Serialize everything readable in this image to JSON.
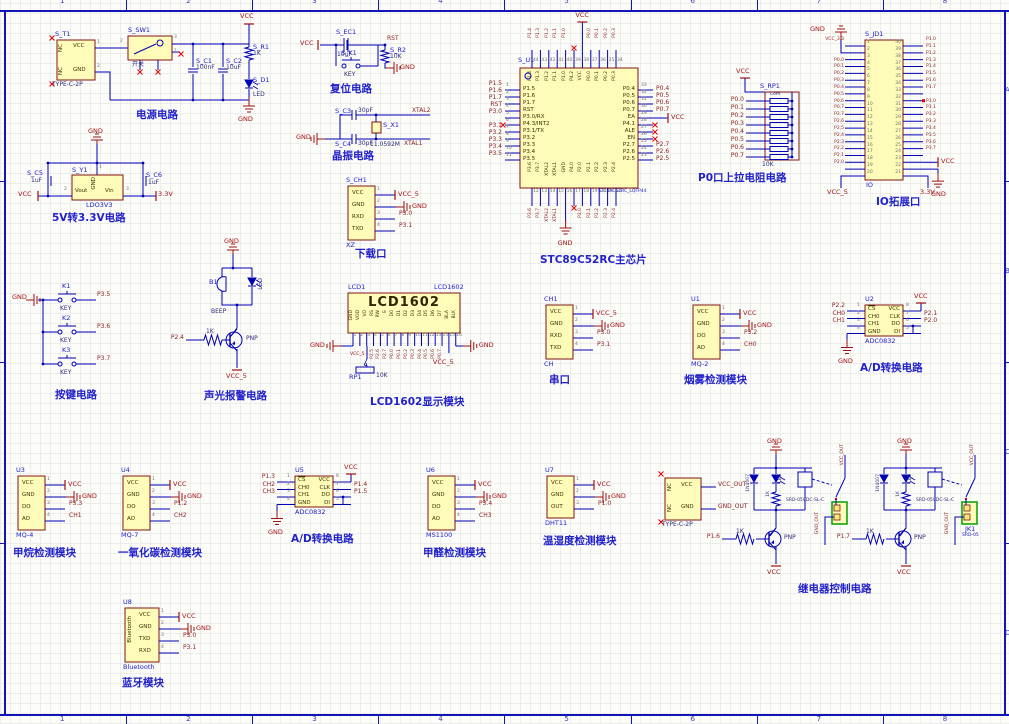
{
  "sheet": {
    "column_labels": [
      "1",
      "2",
      "3",
      "4",
      "5",
      "6",
      "7",
      "8"
    ],
    "row_labels": [
      "A",
      "B",
      "C",
      "D"
    ]
  },
  "colors": {
    "wire": "#0000b4",
    "part_fill": "#fffbb8",
    "part_border": "#801515",
    "net_label": "#8b1c1c",
    "power": "#a01010",
    "designator": "#1a1ad0",
    "caption": "#2222cc",
    "terminal_green": "#00a000"
  },
  "power_circuit": {
    "caption": "电源电路",
    "vcc": "VCC",
    "gnd": "GND",
    "t1": {
      "designator": "S_T1",
      "part": "TYPE-C-2P",
      "pin_vcc": "VCC",
      "pin_gnd": "GND",
      "nc": "NC",
      "pin1": "1",
      "pin2": "2"
    },
    "sw": {
      "designator": "S_SW1",
      "label": "开关",
      "pin2": "2",
      "pin3": "3",
      "pin1": "1"
    },
    "c1": {
      "designator": "S_C1",
      "value": "100nF"
    },
    "c2": {
      "designator": "S_C2",
      "value": "10uF"
    },
    "r1": {
      "designator": "S_R1",
      "value": "1K"
    },
    "d1": {
      "designator": "S_D1",
      "label": "LED"
    }
  },
  "ldo_circuit": {
    "caption": "5V转3.3V电路",
    "gnd": "GND",
    "vcc": "VCC",
    "v33": "3.3V",
    "y1": {
      "designator": "S_Y1",
      "part": "LDO3V3",
      "pin_vout": "Vout",
      "pin_gnd": "GND",
      "pin_vin": "Vin",
      "n1": "1",
      "n2": "2",
      "n3": "3"
    },
    "c5": {
      "designator": "S_C5",
      "value": "1uF"
    },
    "c6": {
      "designator": "S_C6",
      "value": "1uF"
    }
  },
  "reset_circuit": {
    "caption": "复位电路",
    "vcc": "VCC",
    "rst": "RST",
    "gnd": "GND",
    "ec1": {
      "designator": "S_EC1",
      "value": "10uF"
    },
    "k1": {
      "designator": "S_K1",
      "label": "KEY"
    },
    "r2": {
      "designator": "S_R2",
      "value": "10K"
    }
  },
  "crystal_circuit": {
    "caption": "晶振电路",
    "gnd": "GND",
    "xtal2": "XTAL2",
    "xtal1": "XTAL1",
    "c3": {
      "designator": "S_C3",
      "value": "30pF"
    },
    "c4": {
      "designator": "S_C4",
      "value": "30pF"
    },
    "x1": {
      "designator": "S_X1",
      "value": "11.0592M"
    }
  },
  "mcu": {
    "caption": "STC89C52RC主芯片",
    "designator": "S_U1",
    "part": "STC89C52RC_LQFP44",
    "vcc": "VCC",
    "gnd": "GND",
    "ea_net": "VCC",
    "left_pins": [
      {
        "num": "1",
        "name": "P1.5",
        "net": "P1.5"
      },
      {
        "num": "2",
        "name": "P1.6",
        "net": "P1.6"
      },
      {
        "num": "3",
        "name": "P1.7",
        "net": "P1.7"
      },
      {
        "num": "4",
        "name": "RST",
        "net": "RST"
      },
      {
        "num": "5",
        "name": "P3.0/RX",
        "net": "P3.0"
      },
      {
        "num": "6",
        "name": "P4.3/INT2",
        "net": ""
      },
      {
        "num": "7",
        "name": "P3.1/TX",
        "net": "P3.1"
      },
      {
        "num": "8",
        "name": "P3.2",
        "net": "P3.2"
      },
      {
        "num": "9",
        "name": "P3.3",
        "net": "P3.3"
      },
      {
        "num": "10",
        "name": "P3.4",
        "net": "P3.4"
      },
      {
        "num": "11",
        "name": "P3.5",
        "net": "P3.5"
      }
    ],
    "top_pins": [
      {
        "num": "44",
        "name": "P1.4",
        "net": "P1.4"
      },
      {
        "num": "43",
        "name": "P1.3",
        "net": "P1.3"
      },
      {
        "num": "42",
        "name": "P1.2",
        "net": "P1.2"
      },
      {
        "num": "41",
        "name": "P1.1",
        "net": "P1.1"
      },
      {
        "num": "40",
        "name": "P1.0",
        "net": "P1.0"
      },
      {
        "num": "39",
        "name": "P4.2",
        "net": ""
      },
      {
        "num": "38",
        "name": "VCC",
        "net": "VCC"
      },
      {
        "num": "37",
        "name": "P0.0",
        "net": "P0.0"
      },
      {
        "num": "36",
        "name": "P0.1",
        "net": "P0.1"
      },
      {
        "num": "35",
        "name": "P0.2",
        "net": "P0.2"
      },
      {
        "num": "34",
        "name": "P0.3",
        "net": "P0.3"
      }
    ],
    "right_pins": [
      {
        "num": "33",
        "name": "P0.4",
        "net": "P0.4"
      },
      {
        "num": "32",
        "name": "P0.5",
        "net": "P0.5"
      },
      {
        "num": "31",
        "name": "P0.6",
        "net": "P0.6"
      },
      {
        "num": "30",
        "name": "P0.7",
        "net": "P0.7"
      },
      {
        "num": "29",
        "name": "EA",
        "net": "VCC"
      },
      {
        "num": "28",
        "name": "P4.1",
        "net": ""
      },
      {
        "num": "27",
        "name": "ALE",
        "net": ""
      },
      {
        "num": "26",
        "name": "EN",
        "net": ""
      },
      {
        "num": "25",
        "name": "P2.7",
        "net": "P2.7"
      },
      {
        "num": "24",
        "name": "P2.6",
        "net": "P2.6"
      },
      {
        "num": "23",
        "name": "P2.5",
        "net": "P2.5"
      }
    ],
    "bottom_pins": [
      {
        "num": "12",
        "name": "P3.6",
        "net": "P3.6"
      },
      {
        "num": "13",
        "name": "P3.7",
        "net": "P3.7"
      },
      {
        "num": "14",
        "name": "XTAL2",
        "net": "XTAL2"
      },
      {
        "num": "15",
        "name": "XTAL1",
        "net": "XTAL1"
      },
      {
        "num": "16",
        "name": "GND",
        "net": "GND"
      },
      {
        "num": "17",
        "name": "P4.0",
        "net": ""
      },
      {
        "num": "18",
        "name": "P2.0",
        "net": "P2.0"
      },
      {
        "num": "19",
        "name": "P2.1",
        "net": "P2.1"
      },
      {
        "num": "20",
        "name": "P2.2",
        "net": "P2.2"
      },
      {
        "num": "21",
        "name": "P2.3",
        "net": "P2.3"
      },
      {
        "num": "22",
        "name": "P2.4",
        "net": "P2.4"
      }
    ]
  },
  "p0_pullup": {
    "caption": "P0口上拉电阻电路",
    "designator": "S_RP1",
    "com": "Com",
    "value": "10K",
    "vcc": "VCC",
    "nets": [
      "P0.0",
      "P0.1",
      "P0.2",
      "P0.3",
      "P0.4",
      "P0.5",
      "P0.6",
      "P0.7"
    ]
  },
  "io_port": {
    "caption": "IO拓展口",
    "designator": "S_JD1",
    "part": "IO",
    "vcc5": "VCC_5",
    "v33": "3.3V",
    "vcc": "VCC",
    "gnd": "GND",
    "left": [
      {
        "num": "1",
        "net": "VCC_3.3"
      },
      {
        "num": "2",
        "net": "GND"
      },
      {
        "num": "3",
        "net": ""
      },
      {
        "num": "4",
        "net": "P0.0"
      },
      {
        "num": "5",
        "net": "P0.1"
      },
      {
        "num": "6",
        "net": "P0.2"
      },
      {
        "num": "7",
        "net": "P0.3"
      },
      {
        "num": "8",
        "net": "P0.4"
      },
      {
        "num": "9",
        "net": "P0.5"
      },
      {
        "num": "10",
        "net": "P0.6"
      },
      {
        "num": "11",
        "net": "P0.7"
      },
      {
        "num": "12",
        "net": "P2.7"
      },
      {
        "num": "13",
        "net": "P2.6"
      },
      {
        "num": "14",
        "net": "P2.5"
      },
      {
        "num": "15",
        "net": "P2.4"
      },
      {
        "num": "16",
        "net": "P2.3"
      },
      {
        "num": "17",
        "net": "P2.2"
      },
      {
        "num": "18",
        "net": "P2.1"
      },
      {
        "num": "19",
        "net": "P2.0"
      },
      {
        "num": "20",
        "net": ""
      }
    ],
    "right": [
      {
        "num": "40",
        "net": "P1.0"
      },
      {
        "num": "39",
        "net": "P1.1"
      },
      {
        "num": "38",
        "net": "P1.2"
      },
      {
        "num": "37",
        "net": "P1.3"
      },
      {
        "num": "36",
        "net": "P1.4"
      },
      {
        "num": "35",
        "net": "P1.5"
      },
      {
        "num": "34",
        "net": "P1.6"
      },
      {
        "num": "33",
        "net": "P1.7"
      },
      {
        "num": "32",
        "net": ""
      },
      {
        "num": "31",
        "net": "P3.0"
      },
      {
        "num": "30",
        "net": "P3.1"
      },
      {
        "num": "29",
        "net": "P3.2"
      },
      {
        "num": "28",
        "net": "P3.3"
      },
      {
        "num": "27",
        "net": "P3.4"
      },
      {
        "num": "26",
        "net": "P3.5"
      },
      {
        "num": "25",
        "net": "P3.6"
      },
      {
        "num": "24",
        "net": "P3.7"
      },
      {
        "num": "23",
        "net": "VCC"
      },
      {
        "num": "22",
        "net": ""
      },
      {
        "num": "21",
        "net": ""
      }
    ]
  },
  "keys_circuit": {
    "caption": "按键电路",
    "gnd": "GND",
    "keys": [
      {
        "designator": "K1",
        "label": "KEY",
        "net": "P3.5"
      },
      {
        "designator": "K2",
        "label": "KEY",
        "net": "P3.6"
      },
      {
        "designator": "K3",
        "label": "KEY",
        "net": "P3.7"
      }
    ]
  },
  "alarm_circuit": {
    "caption": "声光报警电路",
    "gnd": "GND",
    "vcc": "VCC_5",
    "input_net": "P2.4",
    "resistor": "1K",
    "transistor": "PNP",
    "led": "LED",
    "buzzer": {
      "designator": "B1",
      "label": "BEEP"
    }
  },
  "lcd_module": {
    "caption": "LCD1602显示模块",
    "designator": "LCD1",
    "part": "LCD1602",
    "title": "LCD1602",
    "gnd": "GND",
    "vcc5": "VCC_5",
    "pins": [
      "GND",
      "VDD",
      "VO",
      "RS",
      "RW",
      "E",
      "D0",
      "D1",
      "D2",
      "D3",
      "D4",
      "D5",
      "D6",
      "D7",
      "BLA",
      "BLK"
    ],
    "pin_numbers": [
      "1",
      "2",
      "3",
      "4",
      "5",
      "6",
      "7",
      "8",
      "9",
      "10",
      "11",
      "12",
      "13",
      "14",
      "15",
      "16"
    ],
    "nets": [
      "P2.5",
      "P2.6",
      "P2.7",
      "P0.0",
      "P0.1",
      "P0.2",
      "P0.3",
      "P0.4",
      "P0.5",
      "P0.6",
      "P0.7"
    ],
    "pot": {
      "designator": "RP1",
      "value": "10K"
    }
  },
  "pin_modules": [
    {
      "id": "download",
      "designator": "S_CH1",
      "part": "XZ",
      "caption": "下载口",
      "pins": [
        {
          "name": "VCC",
          "num": "1",
          "net": "VCC_5",
          "t": "vcc"
        },
        {
          "name": "GND",
          "num": "2",
          "net": "GND",
          "t": "gnd"
        },
        {
          "name": "RXD",
          "num": "3",
          "net": "P3.0",
          "t": "net"
        },
        {
          "name": "TXD",
          "num": "4",
          "net": "P3.1",
          "t": "net"
        }
      ]
    },
    {
      "id": "serial",
      "designator": "CH1",
      "part": "CH",
      "caption": "串口",
      "pins": [
        {
          "name": "VCC",
          "num": "1",
          "net": "VCC_5",
          "t": "vcc"
        },
        {
          "name": "GND",
          "num": "2",
          "net": "GND",
          "t": "gnd"
        },
        {
          "name": "RXD",
          "num": "3",
          "net": "P3.0",
          "t": "net"
        },
        {
          "name": "TXD",
          "num": "4",
          "net": "P3.1",
          "t": "net"
        }
      ]
    },
    {
      "id": "smoke",
      "designator": "U1",
      "part": "MQ-2",
      "caption": "烟雾检测模块",
      "pins": [
        {
          "name": "VCC",
          "num": "1",
          "net": "VCC",
          "t": "vcc"
        },
        {
          "name": "GND",
          "num": "2",
          "net": "GND",
          "t": "gnd"
        },
        {
          "name": "DO",
          "num": "3",
          "net": "P3.2",
          "t": "net"
        },
        {
          "name": "AO",
          "num": "4",
          "net": "CH0",
          "t": "net"
        }
      ]
    },
    {
      "id": "methane",
      "designator": "U3",
      "part": "MQ-4",
      "caption": "甲烷检测模块",
      "pins": [
        {
          "name": "VCC",
          "num": "1",
          "net": "VCC",
          "t": "vcc"
        },
        {
          "name": "GND",
          "num": "2",
          "net": "GND",
          "t": "gnd"
        },
        {
          "name": "DO",
          "num": "3",
          "net": "P3.3",
          "t": "net"
        },
        {
          "name": "AO",
          "num": "4",
          "net": "CH1",
          "t": "net"
        }
      ]
    },
    {
      "id": "co",
      "designator": "U4",
      "part": "MQ-7",
      "caption": "一氧化碳检测模块",
      "pins": [
        {
          "name": "VCC",
          "num": "1",
          "net": "VCC",
          "t": "vcc"
        },
        {
          "name": "GND",
          "num": "2",
          "net": "GND",
          "t": "gnd"
        },
        {
          "name": "DO",
          "num": "3",
          "net": "P1.2",
          "t": "net"
        },
        {
          "name": "AO",
          "num": "4",
          "net": "CH2",
          "t": "net"
        }
      ]
    },
    {
      "id": "formaldehyde",
      "designator": "U6",
      "part": "MS1100",
      "caption": "甲醛检测模块",
      "pins": [
        {
          "name": "VCC",
          "num": "1",
          "net": "VCC",
          "t": "vcc"
        },
        {
          "name": "GND",
          "num": "2",
          "net": "GND",
          "t": "gnd"
        },
        {
          "name": "DO",
          "num": "3",
          "net": "P3.4",
          "t": "net"
        },
        {
          "name": "AO",
          "num": "4",
          "net": "CH3",
          "t": "net"
        }
      ]
    },
    {
      "id": "dht",
      "designator": "U7",
      "part": "DHT11",
      "caption": "温湿度检测模块",
      "pins": [
        {
          "name": "VCC",
          "num": "1",
          "net": "VCC",
          "t": "vcc"
        },
        {
          "name": "GND",
          "num": "2",
          "net": "GND",
          "t": "gnd"
        },
        {
          "name": "OUT",
          "num": "3",
          "net": "P1.0",
          "t": "net"
        }
      ]
    },
    {
      "id": "bluetooth",
      "designator": "U8",
      "part": "Bluetooth",
      "caption": "蓝牙模块",
      "vertical_label": "Bluetooth",
      "pins": [
        {
          "name": "VCC",
          "num": "1",
          "net": "VCC",
          "t": "vcc"
        },
        {
          "name": "GND",
          "num": "2",
          "net": "GND",
          "t": "gnd"
        },
        {
          "name": "TXD",
          "num": "3",
          "net": "P3.0",
          "t": "net"
        },
        {
          "name": "RXD",
          "num": "4",
          "net": "P3.1",
          "t": "net"
        }
      ]
    }
  ],
  "adc_modules": [
    {
      "id": "adc1",
      "designator": "U2",
      "part": "ADC0832",
      "caption": "A/D转换电路",
      "left_pins": [
        {
          "num": "1",
          "name": "CS",
          "net": "P2.2"
        },
        {
          "num": "2",
          "name": "CH0",
          "net": "CH0"
        },
        {
          "num": "3",
          "name": "CH1",
          "net": "CH1"
        },
        {
          "num": "4",
          "name": "GND",
          "net": "GND"
        }
      ],
      "right_pins": [
        {
          "num": "8",
          "name": "VCC",
          "net": "VCC"
        },
        {
          "num": "7",
          "name": "CLK",
          "net": "P2.1"
        },
        {
          "num": "6",
          "name": "DO",
          "net": "P2.0"
        },
        {
          "num": "5",
          "name": "DI",
          "net": ""
        }
      ]
    },
    {
      "id": "adc2",
      "designator": "U5",
      "part": "ADC0832",
      "caption": "A/D转换电路",
      "left_pins": [
        {
          "num": "1",
          "name": "CS",
          "net": "P1.3"
        },
        {
          "num": "2",
          "name": "CH0",
          "net": "CH2"
        },
        {
          "num": "3",
          "name": "CH1",
          "net": "CH3"
        },
        {
          "num": "4",
          "name": "GND",
          "net": "GND"
        }
      ],
      "right_pins": [
        {
          "num": "8",
          "name": "VCC",
          "net": "VCC"
        },
        {
          "num": "7",
          "name": "CLK",
          "net": "P1.4"
        },
        {
          "num": "6",
          "name": "DO",
          "net": "P1.5"
        },
        {
          "num": "5",
          "name": "DI",
          "net": ""
        }
      ]
    }
  ],
  "relay_circuit": {
    "caption": "继电器控制电路",
    "connector": {
      "part": "TYPE-C-2P",
      "pin_vcc": "VCC",
      "pin_gnd": "GND",
      "net_vcc": "VCC_OUT",
      "net_gnd": "GND_OUT",
      "nc": "NC"
    },
    "channels": [
      {
        "input_net": "P1.6",
        "base_res": "1K",
        "transistor": "PNP",
        "diode": "1N4007",
        "led": "LED",
        "res": "1K",
        "relay_part": "SRD-05VDC-SL-C",
        "vcc_out": "VCC_OUT",
        "gnd_out": "GND_OUT",
        "gnd": "GND",
        "vcc": "VCC",
        "terminal_designator": "",
        "terminal_part": ""
      },
      {
        "input_net": "P1.7",
        "base_res": "1K",
        "transistor": "PNP",
        "diode": "1N4007",
        "led": "LED",
        "res": "1K",
        "relay_part": "SRD-05VDC-SL-C",
        "vcc_out": "VCC_OUT",
        "gnd_out": "GND_OUT",
        "gnd": "GND",
        "vcc": "VCC",
        "terminal_designator": "JK1",
        "terminal_part": "SRD-05"
      }
    ]
  }
}
